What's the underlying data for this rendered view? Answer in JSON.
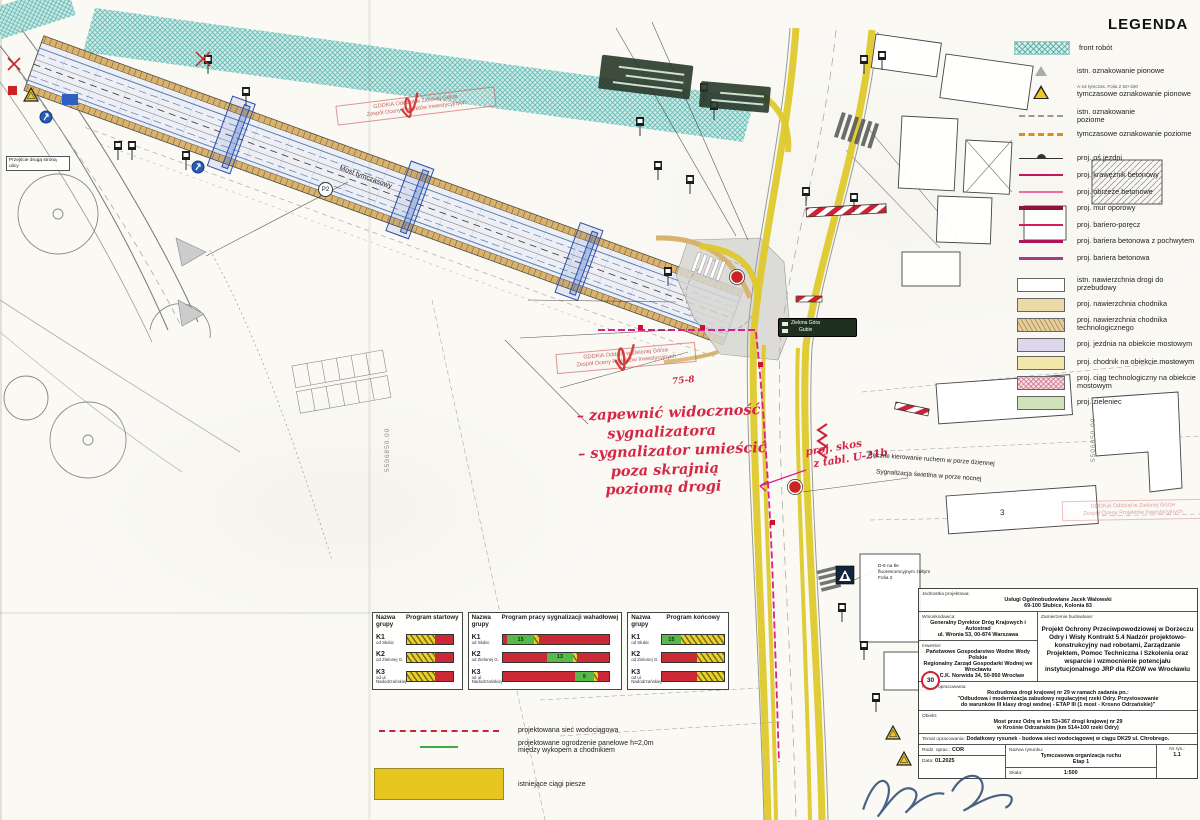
{
  "legend": {
    "title": "LEGENDA",
    "a7_note": "A-7 ist.",
    "a14_note": "A-14 tymczas. Folia 2 52+340",
    "items": [
      {
        "label": "front robót"
      },
      {
        "label": "istn. oznakowanie pionowe"
      },
      {
        "label": "tymczasowe oznakowanie pionowe"
      },
      {
        "label": "istn. oznakowanie poziome"
      },
      {
        "label": "tymczasowe oznakowanie poziome"
      },
      {
        "label": "proj. oś jezdni"
      },
      {
        "label": "proj. krawężnik betonowy"
      },
      {
        "label": "proj. obrzeże betonowe"
      },
      {
        "label": "proj. mur oporowy"
      },
      {
        "label": "proj. bariero-poręcz"
      },
      {
        "label": "proj. bariera betonowa z pochwytem"
      },
      {
        "label": "proj. bariera betonowa"
      },
      {
        "label": "istn. nawierzchnia drogi do przebudowy"
      },
      {
        "label": "proj. nawierzchnia chodnika"
      },
      {
        "label": "proj. nawierzchnia chodnika technologicznego"
      },
      {
        "label": "proj. jezdnia na obiekcie mostowym"
      },
      {
        "label": "proj. chodnik na obiekcie mostowym"
      },
      {
        "label": "proj. ciąg technologiczny na obiekcie mostowym"
      },
      {
        "label": "proj. zieleniec"
      }
    ]
  },
  "signal_tables": {
    "group_header": "Nazwa grupy",
    "t1_header": "Program startowy",
    "t2_header": "Program pracy sygnalizacji wahadłowej",
    "t3_header": "Program końcowy",
    "groups": [
      {
        "name": "K1",
        "dir": "od Słubic"
      },
      {
        "name": "K2",
        "dir": "od Zielonej G."
      },
      {
        "name": "K3",
        "dir": "od ul. Nadodrzańskiej"
      }
    ],
    "green_times": {
      "k1": "15",
      "k2": "13",
      "k3": "9",
      "k1_end": "15"
    }
  },
  "site_legend": {
    "water": "projektowana sieć wodociągowa",
    "fence1": "projektowane ogrodzenie panelowe h=2,0m",
    "fence2": "między wykopem a chodnikiem",
    "paths": "istniejące ciągi piesze"
  },
  "title_block": {
    "designer_label": "Jednostka projektowa:",
    "designer": "Usługi Ogólnobudowlane Jacek Walowski",
    "designer_addr": "69-100 Słubice, Kolonia 83",
    "applicant_label": "Wnioskodawca:",
    "applicant": "Generalny Dyrektor Dróg Krajowych i Autostrad",
    "applicant_addr": "ul. Wronia 53, 00-874 Warszawa",
    "investor_label": "Inwestor:",
    "investor1": "Państwowe Gospodarstwo Wodne Wody Polskie",
    "investor2": "Regionalny Zarząd Gospodarki Wodnej we Wrocławiu",
    "investor_addr": "ul. C.K. Norwida 34, 50-950 Wrocław",
    "venture_label": "Zamierzenie budowlane:",
    "venture": "Projekt Ochrony Przeciwpowodziowej w Dorzeczu Odry i Wisły Kontrakt 5.4 Nadzór projektowo-konstrukcyjny nad robotami, Zarządzanie Projektem, Pomoc Techniczna i Szkolenia oraz wsparcie i wzmocnienie potencjału instytucjonalnego JRP dla RZGW we Wrocławiu",
    "work_label": "Nazwa opracowania:",
    "work1": "Rozbudowa drogi krajowej nr 29 w ramach zadania pn.:",
    "work2": "\"Odbudowa i modernizacja zabudowy regulacyjnej rzeki Odry. Przystosowanie",
    "work3": "do warunków III klasy drogi wodnej - ETAP III (1 most - Krosno Odrzańskie)\"",
    "object_label": "Obiekt:",
    "object1": "Most przez Odrę w km 53+367 drogi krajowej nr 29",
    "object2": "w Krośnie Odrzańskim (km 514+100 rzeki Odry)",
    "subject_label": "Temat opracowania:",
    "subject": "Dodatkowy rysunek - budowa sieci wodociągowej w ciągu DK29 ul. Chrobrego.",
    "kind_label": "Rodz. oprac.:",
    "kind": "COR",
    "date_label": "Data:",
    "date": "01.2025",
    "drawing_label": "Nazwa rysunku:",
    "drawing1": "Tymczasowa organizacja ruchu",
    "drawing2": "Etap 1",
    "scale_label": "Skala:",
    "scale": "1:500",
    "no_label": "Nr rys.:",
    "no": "1.1"
  },
  "annotations": {
    "lines": [
      "– zapewnić widoczność",
      "sygnalizatora",
      "– sygnalizator umieścić",
      "poza skrajnią",
      "poziomą drogi"
    ],
    "skos1": "proj. skos",
    "skos2": "z tabl. U-21b",
    "mark": "75-8"
  },
  "notes": {
    "manual_day": "Ręczne kierowanie ruchem w porze dziennej",
    "signal_night": "Sygnalizacja świetlna w porze nocnej",
    "d6_note": "D-6 na tle fluorescencyjnym żółtym Folia 2",
    "temp_bridge": "Most tymczasowy",
    "cross_other_side": "Przejście drugą stroną ulicy",
    "coord": "5506850.00"
  },
  "stamps": {
    "line1": "GDDKiA Oddział w Zielonej Górze",
    "line2": "Zespół Oceny Projektów Inwestycyjnych"
  },
  "signs": {
    "direction_line1": "Zielona Góra",
    "direction_line2": "Gubin",
    "speed": "30",
    "p2": "P2",
    "building3": "3"
  }
}
